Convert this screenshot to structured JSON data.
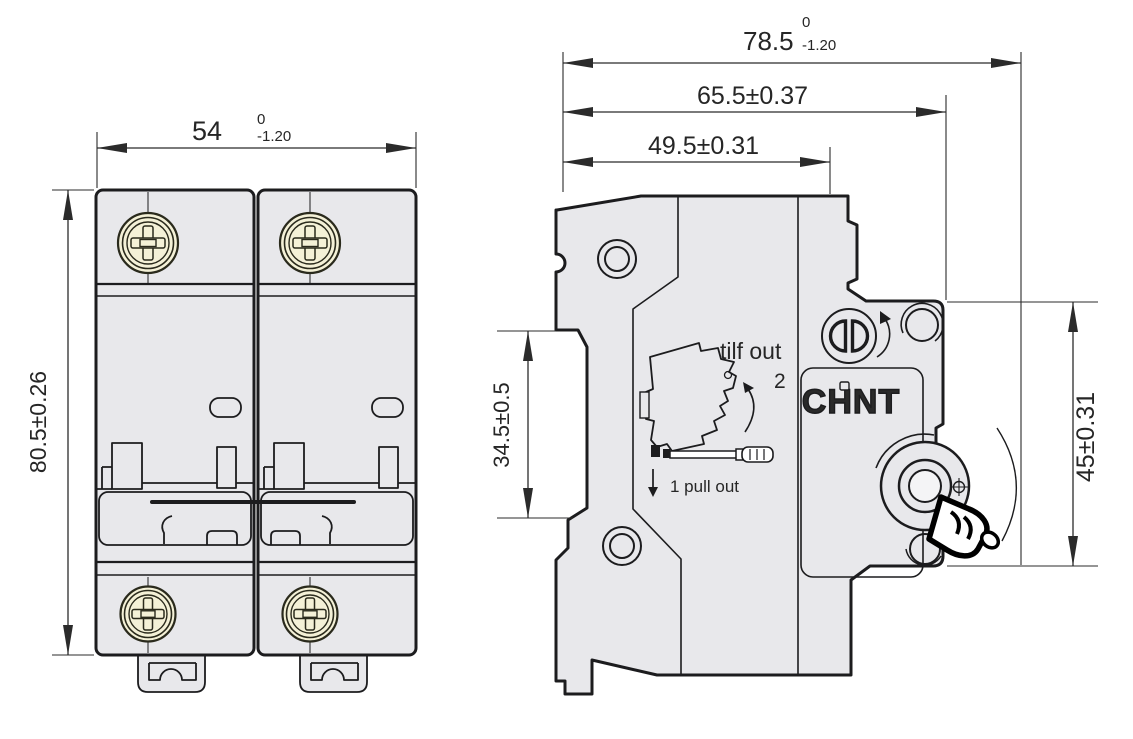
{
  "product": {
    "brand_logo": "CHNT"
  },
  "colors": {
    "body_fill": "#e8e8eb",
    "line": "#1c1c1e",
    "screw_fill": "#f4f1d7",
    "dimension": "#2b2b2b",
    "background": "#ffffff"
  },
  "front_view": {
    "width_dim": {
      "value": "54",
      "tol_top": "0",
      "tol_bottom": "-1.20"
    },
    "height_dim": {
      "value": "80.5±0.26"
    }
  },
  "side_view": {
    "total_depth_dim": {
      "value": "78.5",
      "tol_top": "0",
      "tol_bottom": "-1.20"
    },
    "body_depth_dim": {
      "value": "65.5±0.37"
    },
    "front_depth_dim": {
      "value": "49.5±0.31"
    },
    "rail_slot_dim": {
      "value": "34.5±0.5"
    },
    "handle_height_dim": {
      "value": "45±0.31"
    },
    "brand_logo": "CHNT",
    "instructions": {
      "tilt_label": "tilf out",
      "tilt_step_number": "2",
      "pull_label": "1  pull out"
    }
  }
}
